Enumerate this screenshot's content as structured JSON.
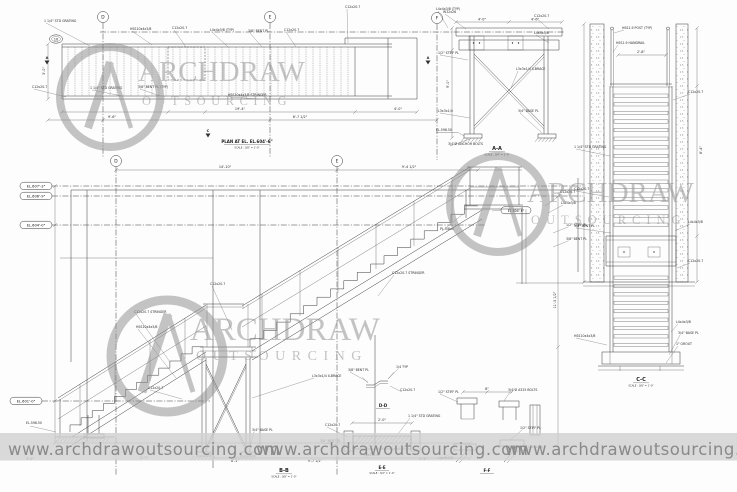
{
  "brand": {
    "name_top": "ARCHDRAW",
    "name_bottom": "OUTSOURCING",
    "url": "www.archdrawoutsourcing.com"
  },
  "titles": {
    "plan_title": "PLAN AT EL. EL.604'-6\"",
    "scale_a": "SCALE : 3/8\" = 1'-0\"",
    "scale_b": "SCALE : 3/4\" = 1'-0\"",
    "section_aa": "A-A",
    "section_bb": "B-B",
    "section_cc": "C-C",
    "detail_dd": "D-D",
    "detail_ee": "E-E",
    "detail_ff": "F-F"
  },
  "grid_bubbles": {
    "b10": "10",
    "d_top": "D",
    "e_top": "E",
    "f_top": "F",
    "d_elev": "D",
    "e_elev": "E"
  },
  "section_markers": {
    "a_left": "A",
    "a_right": "A",
    "c_bottom": "C"
  },
  "levels": {
    "el607": "EL.607'-3\"",
    "el606": "EL.606'-9\"",
    "el604": "EL.604'-0\"",
    "el601": "EL.601'-0\"",
    "el604_6": "EL.604'-6\"",
    "el598_tower": "EL.598.50",
    "el598_elev": "EL.598.50"
  },
  "colors": {
    "line": "#3c3c3c",
    "watermark_gray": "#8f8f8f",
    "banner_bg": "#cfcfcf",
    "banner_text": "#8a8a8a"
  },
  "annotations": {
    "callouts": [
      {
        "t": "1 1/4\" STD GRATING",
        "x": 44,
        "y": 22,
        "lx": 90,
        "ly": 46
      },
      {
        "t": "HSS10x4x3/8",
        "x": 130,
        "y": 30,
        "lx": 152,
        "ly": 45
      },
      {
        "t": "C12x20.7",
        "x": 172,
        "y": 29,
        "lx": 186,
        "ly": 47
      },
      {
        "t": "L4x4x3/8 (TYP)",
        "x": 210,
        "y": 31,
        "lx": 228,
        "ly": 47
      },
      {
        "t": "3/8\" BENT PL",
        "x": 248,
        "y": 32,
        "lx": 262,
        "ly": 47
      },
      {
        "t": "C12x20.7",
        "x": 284,
        "y": 31,
        "lx": 296,
        "ly": 47
      },
      {
        "t": "C12x20.7",
        "x": 345,
        "y": 8,
        "lx": 348,
        "ly": 43
      },
      {
        "t": "L4x4x3/8 (TYP)",
        "x": 436,
        "y": 10,
        "lx": 448,
        "ly": 28
      },
      {
        "t": "C12x20.7",
        "x": 32,
        "y": 88,
        "lx": 66,
        "ly": 97
      },
      {
        "t": "1 1/4\" STD GRATING",
        "x": 90,
        "y": 89,
        "lx": 122,
        "ly": 96
      },
      {
        "t": "3/8\" BENT PL (TYP)",
        "x": 138,
        "y": 88,
        "lx": 160,
        "ly": 96
      },
      {
        "t": "HSS10x4x3/8 STRINGER",
        "x": 228,
        "y": 96,
        "lx": 258,
        "ly": 99
      },
      {
        "t": "W12x26",
        "x": 443,
        "y": 13,
        "lx": 466,
        "ly": 29
      },
      {
        "t": "C12x20.7",
        "x": 534,
        "y": 17,
        "lx": 549,
        "ly": 29
      },
      {
        "t": "L4x4x3/8",
        "x": 534,
        "y": 34,
        "lx": 549,
        "ly": 43
      },
      {
        "t": "1/2\" STIFF PL",
        "x": 438,
        "y": 54,
        "lx": 468,
        "ly": 60
      },
      {
        "t": "L3x3x1/4 X-BRACE",
        "x": 516,
        "y": 70,
        "lx": 511,
        "ly": 88
      },
      {
        "t": "L3x3x1/4",
        "x": 438,
        "y": 112,
        "lx": 470,
        "ly": 118
      },
      {
        "t": "3/4\" BASE PL",
        "x": 518,
        "y": 112,
        "lx": 542,
        "ly": 133
      },
      {
        "t": "3/4\"Ø ANCHOR BOLTS",
        "x": 448,
        "y": 145,
        "lx": 470,
        "ly": 139
      },
      {
        "t": "HSS1.9 POST (TYP)",
        "x": 622,
        "y": 29,
        "lx": 614,
        "ly": 33
      },
      {
        "t": "HSS1.9 HANDRAIL",
        "x": 616,
        "y": 44,
        "lx": 613,
        "ly": 52
      },
      {
        "t": "C12x20.7",
        "x": 688,
        "y": 93,
        "lx": 673,
        "ly": 100
      },
      {
        "t": "1 1/4\" STD GRATING",
        "x": 574,
        "y": 148,
        "lx": 610,
        "ly": 156
      },
      {
        "t": "C12x20.7",
        "x": 574,
        "y": 190,
        "lx": 609,
        "ly": 197
      },
      {
        "t": "3/8\" BENT PL",
        "x": 574,
        "y": 227,
        "lx": 611,
        "ly": 233
      },
      {
        "t": "L4x4x3/8",
        "x": 688,
        "y": 223,
        "lx": 675,
        "ly": 231
      },
      {
        "t": "C12x20.7",
        "x": 688,
        "y": 262,
        "lx": 677,
        "ly": 268
      },
      {
        "t": "HSS10x4x3/8",
        "x": 574,
        "y": 337,
        "lx": 607,
        "ly": 345
      },
      {
        "t": "L4x4x3/8",
        "x": 676,
        "y": 323,
        "lx": 671,
        "ly": 332
      },
      {
        "t": "3/4\" BASE PL",
        "x": 678,
        "y": 334,
        "lx": 669,
        "ly": 355
      },
      {
        "t": "1\" GROUT",
        "x": 676,
        "y": 345,
        "lx": 666,
        "ly": 363
      },
      {
        "t": "C12x20.7 STRINGER",
        "x": 134,
        "y": 313,
        "lx": 170,
        "ly": 362
      },
      {
        "t": "HSS10x4x3/8",
        "x": 136,
        "y": 328,
        "lx": 176,
        "ly": 378
      },
      {
        "t": "C12x20.7 STRINGER",
        "x": 392,
        "y": 274,
        "lx": 378,
        "ly": 296
      },
      {
        "t": "C12x20.7",
        "x": 560,
        "y": 193,
        "lx": 545,
        "ly": 206
      },
      {
        "t": "L4x4x3/8",
        "x": 561,
        "y": 204,
        "lx": 548,
        "ly": 213
      },
      {
        "t": "1/2\" STIFF PL",
        "x": 566,
        "y": 226,
        "lx": 553,
        "ly": 233
      },
      {
        "t": "3/8\" BENT PL",
        "x": 566,
        "y": 240,
        "lx": 553,
        "ly": 247
      },
      {
        "t": "L3x3x1/4 X-BRACE",
        "x": 312,
        "y": 377,
        "lx": 252,
        "ly": 398
      },
      {
        "t": "C12x20.7",
        "x": 148,
        "y": 389,
        "lx": 182,
        "ly": 399
      },
      {
        "t": "3/4\" BASE PL",
        "x": 252,
        "y": 431,
        "lx": 249,
        "ly": 451
      },
      {
        "t": "C12x20.7",
        "x": 210,
        "y": 285,
        "lx": 232,
        "ly": 330
      },
      {
        "t": "PL 3/8x4",
        "x": 440,
        "y": 230,
        "lx": 463,
        "ly": 214
      },
      {
        "t": "3/8\" BENT PL",
        "x": 348,
        "y": 371,
        "lx": 368,
        "ly": 382
      },
      {
        "t": "1/4 TYP",
        "x": 396,
        "y": 368,
        "lx": 388,
        "ly": 379
      },
      {
        "t": "C12x20.7",
        "x": 400,
        "y": 391,
        "lx": 390,
        "ly": 386
      },
      {
        "t": "C12x20.7",
        "x": 325,
        "y": 426,
        "lx": 348,
        "ly": 437
      },
      {
        "t": "1 1/4\" STD GRATING",
        "x": 408,
        "y": 417,
        "lx": 398,
        "ly": 434
      },
      {
        "t": "3/8\" BENT PL",
        "x": 320,
        "y": 442,
        "lx": 350,
        "ly": 446
      },
      {
        "t": "L2x2x1/4",
        "x": 364,
        "y": 456,
        "lx": 374,
        "ly": 451
      },
      {
        "t": "1/2\" STIFF PL",
        "x": 438,
        "y": 393,
        "lx": 458,
        "ly": 402
      },
      {
        "t": "3/4\"Ø A325 BOLTS",
        "x": 508,
        "y": 391,
        "lx": 504,
        "ly": 401
      },
      {
        "t": "L4x4x3/8",
        "x": 438,
        "y": 459,
        "lx": 456,
        "ly": 450
      },
      {
        "t": "1/2\" STIFF PL",
        "x": 520,
        "y": 429,
        "lx": 510,
        "ly": 440
      },
      {
        "t": "L4x4x3/8",
        "x": 528,
        "y": 448,
        "lx": 517,
        "ly": 452
      }
    ],
    "dims": [
      {
        "t": "19'-4\"",
        "x": 240,
        "y": 110
      },
      {
        "t": "9'-6\"",
        "x": 112,
        "y": 118
      },
      {
        "t": "6'-7 1/2\"",
        "x": 300,
        "y": 118
      },
      {
        "t": "4'-0\"",
        "x": 398,
        "y": 110
      },
      {
        "t": "3'-0\"",
        "x": 45,
        "y": 71,
        "r": -90
      },
      {
        "t": "4'-0\"",
        "x": 482,
        "y": 20.5
      },
      {
        "t": "4'-0\"",
        "x": 535,
        "y": 20.5
      },
      {
        "t": "9'-0\"",
        "x": 449,
        "y": 84,
        "r": -90
      },
      {
        "t": "2'-8\"",
        "x": 641,
        "y": 53
      },
      {
        "t": "8'-4\"",
        "x": 702,
        "y": 150,
        "r": -90
      },
      {
        "t": "14'-10\"",
        "x": 225,
        "y": 168
      },
      {
        "t": "9'-4 1/2\"",
        "x": 409,
        "y": 168
      },
      {
        "t": "11'-5 1/2\"",
        "x": 556,
        "y": 300,
        "r": -90
      },
      {
        "t": "3'-0\"",
        "x": 30,
        "y": 460
      },
      {
        "t": "2'-7\"",
        "x": 144,
        "y": 459
      },
      {
        "t": "8'-1\"",
        "x": 235,
        "y": 462
      },
      {
        "t": "9'-7 1/2\"",
        "x": 315,
        "y": 462
      },
      {
        "t": "2'-4\"",
        "x": 423,
        "y": 460
      },
      {
        "t": "2'-0\"",
        "x": 382,
        "y": 421
      },
      {
        "t": "8\"",
        "x": 487,
        "y": 390
      }
    ]
  }
}
